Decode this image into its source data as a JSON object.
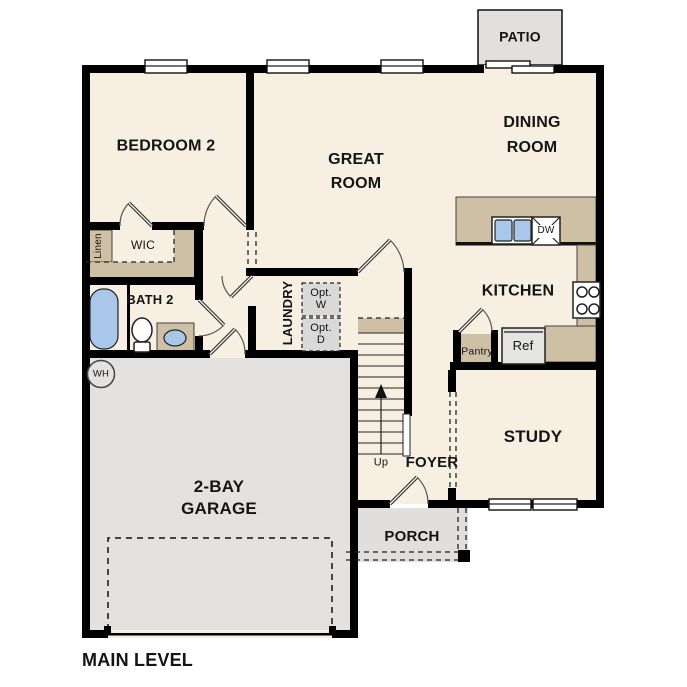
{
  "title": "MAIN LEVEL",
  "colors": {
    "floor": "#f7efe2",
    "counter": "#cec0a5",
    "garage": "#e3e2e0",
    "patio": "#e1e0de",
    "porch": "#e0dfdd",
    "optional_box": "#d9d9d9",
    "fixture_blue": "#a9c7e8",
    "appliance_gray": "#e4e4e2",
    "wall": "#000000"
  },
  "rooms": {
    "bedroom2": "BEDROOM 2",
    "great_room": "GREAT\nROOM",
    "dining_room": "DINING\nROOM",
    "kitchen": "KITCHEN",
    "study": "STUDY",
    "foyer": "FOYER",
    "porch": "PORCH",
    "patio": "PATIO",
    "garage": "2-BAY\nGARAGE",
    "bath2": "BATH 2",
    "laundry": "LAUNDRY",
    "wic": "WIC",
    "linen": "Linen"
  },
  "fixtures": {
    "water_heater": "WH",
    "dishwasher": "DW",
    "refrigerator": "Ref",
    "pantry": "Pantry",
    "opt_washer": "Opt.\nW",
    "opt_dryer": "Opt.\nD",
    "stairs_up": "Up"
  }
}
